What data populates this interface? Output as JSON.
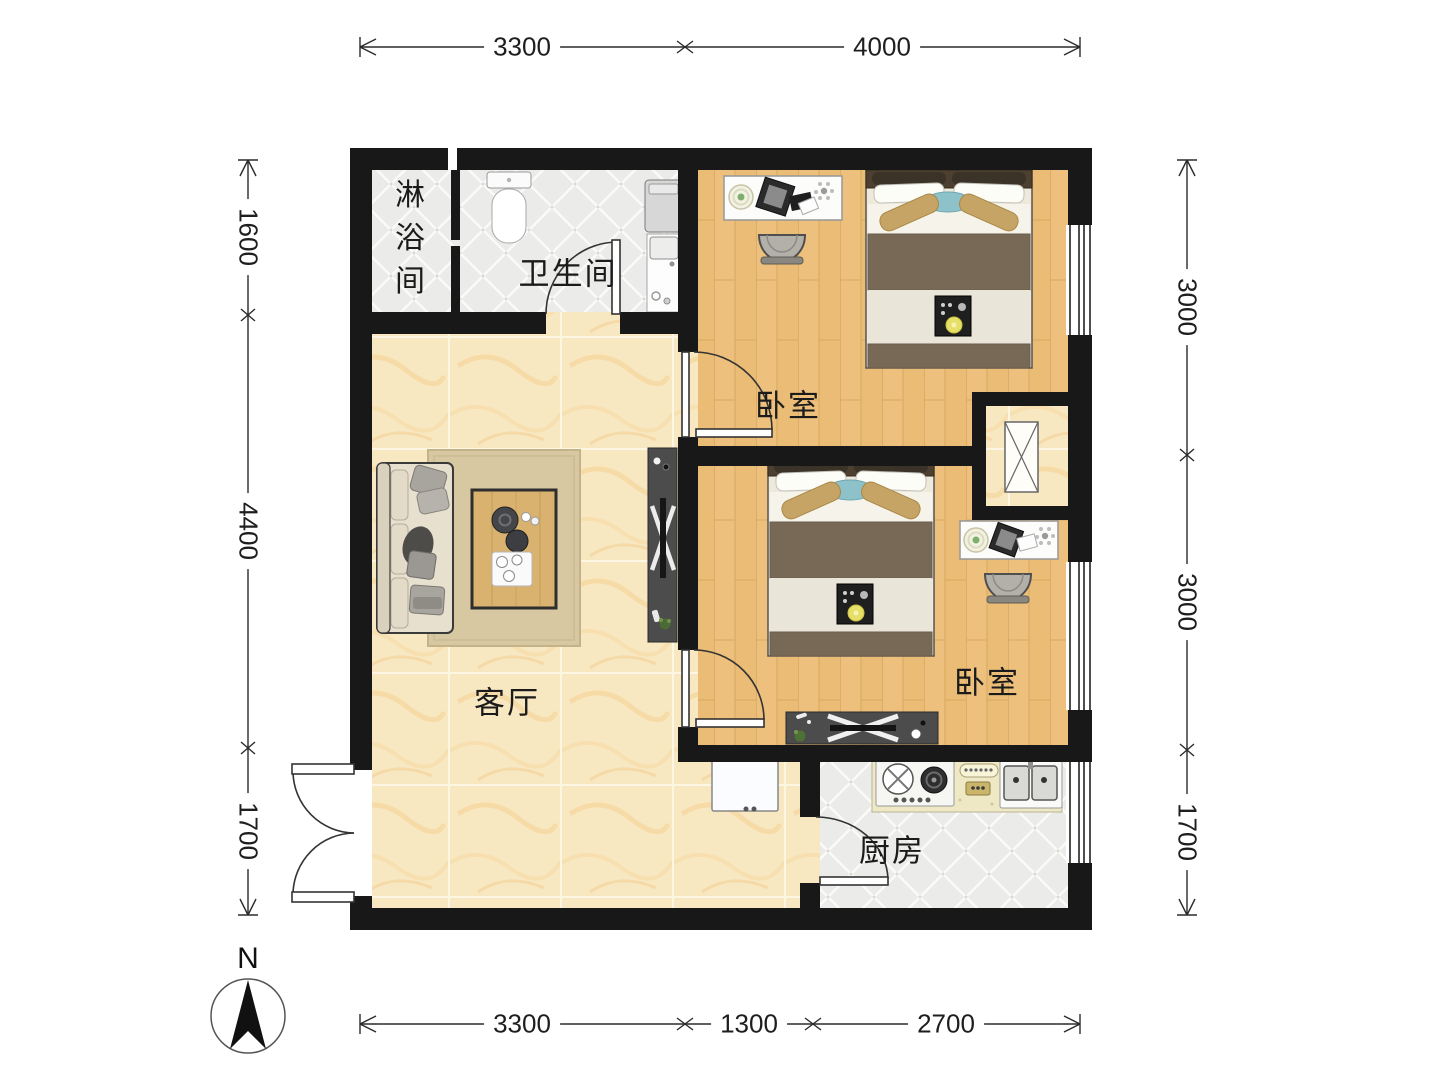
{
  "rooms": {
    "shower": "淋浴间",
    "bathroom": "卫生间",
    "bedroom_top": "卧室",
    "bedroom_bottom": "卧室",
    "living": "客厅",
    "kitchen": "厨房"
  },
  "dimensions": {
    "top": [
      "3300",
      "4000"
    ],
    "bottom": [
      "3300",
      "1300",
      "2700"
    ],
    "left": [
      "1600",
      "4400",
      "1700"
    ],
    "right": [
      "3000",
      "3000",
      "1700"
    ]
  },
  "compass": {
    "north_label": "N"
  },
  "colors": {
    "wall": "#181818",
    "wood_floor": "#edc17d",
    "marble_floor": "#f8e8c2",
    "tile_floor": "#ebebe9",
    "counter": "#eee8c4",
    "accent_teal": "#8ec2ca",
    "blanket_brown": "#776955",
    "dim_line": "#2b2b2b"
  }
}
